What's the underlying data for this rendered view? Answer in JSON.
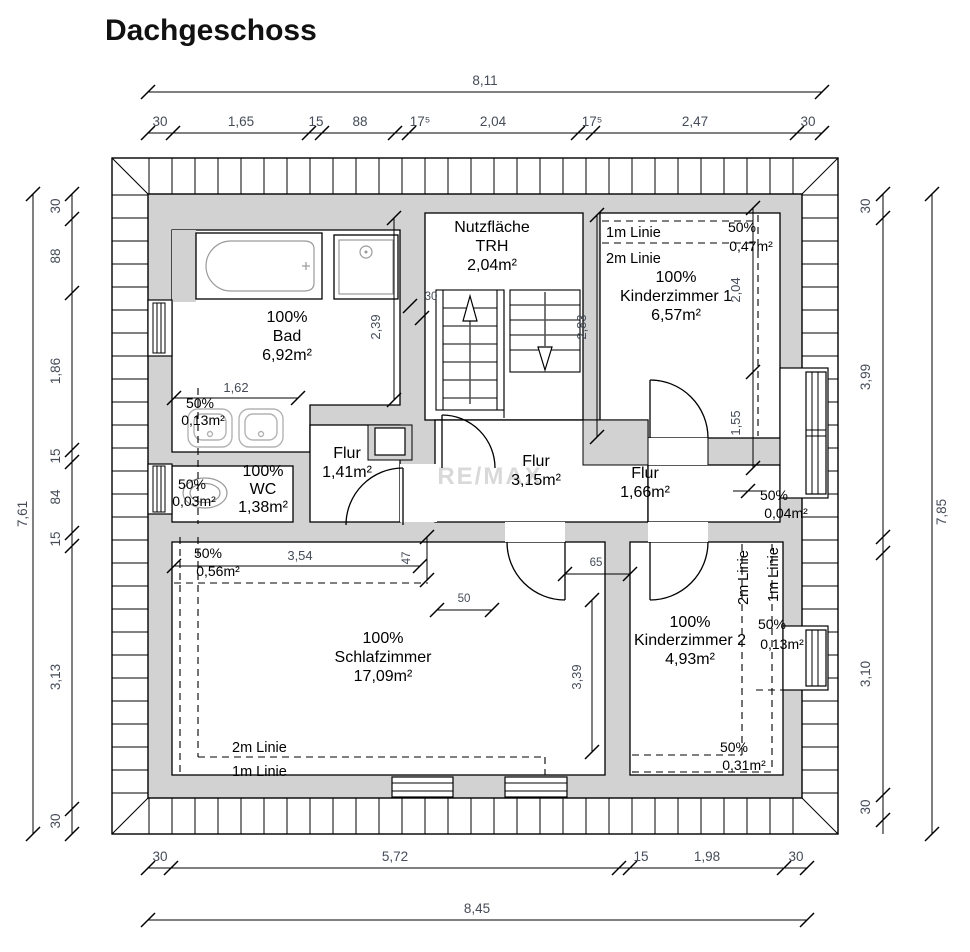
{
  "title": "Dachgeschoss",
  "watermark": "RE/MAX",
  "colors": {
    "wall_fill": "#d2d2d2",
    "dim_text": "#454c58",
    "watermark": "#d9d9d9"
  },
  "rooms": {
    "bad": {
      "lines": [
        "100%",
        "Bad",
        "6,92m²"
      ]
    },
    "trh": {
      "lines": [
        "Nutzfläche",
        "TRH",
        "2,04m²"
      ]
    },
    "kinderzimmer1": {
      "lines": [
        "100%",
        "Kinderzimmer 1",
        "6,57m²"
      ]
    },
    "wc": {
      "lines": [
        "100%",
        "WC",
        "1,38m²"
      ]
    },
    "flur_141": {
      "lines": [
        "Flur",
        "1,41m²"
      ]
    },
    "flur_315": {
      "lines": [
        "Flur",
        "3,15m²"
      ]
    },
    "flur_166": {
      "lines": [
        "Flur",
        "1,66m²"
      ]
    },
    "schlafzimmer": {
      "lines": [
        "100%",
        "Schlafzimmer",
        "17,09m²"
      ]
    },
    "kinderzimmer2": {
      "lines": [
        "100%",
        "Kinderzimmer 2",
        "4,93m²"
      ]
    }
  },
  "zones": {
    "bad": [
      "50%",
      "0,13m²"
    ],
    "wc": [
      "50%",
      "0,03m²"
    ],
    "schlafzimmer": [
      "50%",
      "0,56m²"
    ],
    "kinderzimmer1": [
      "50%",
      "0,47m²"
    ],
    "flur": [
      "50%",
      "0,04m²"
    ],
    "kinderzimmer2_mid": [
      "50%",
      "0,13m²"
    ],
    "kinderzimmer2_bottom": [
      "50%",
      "0,31m²"
    ]
  },
  "linie": {
    "one_m": "1m Linie",
    "two_m": "2m Linie"
  },
  "dims": {
    "top": {
      "total": "8,11",
      "segments": [
        "30",
        "1,65",
        "15",
        "88",
        "17⁵",
        "2,04",
        "17⁵",
        "2,47",
        "30"
      ]
    },
    "bottom": {
      "total": "8,45",
      "segments": [
        "30",
        "5,72",
        "15",
        "1,98",
        "30"
      ]
    },
    "left": {
      "total": "7,61",
      "segments": [
        "30",
        "88",
        "1,86",
        "15",
        "84",
        "15",
        "3,13",
        "30"
      ]
    },
    "right": {
      "total": "7,85",
      "segments": [
        "30",
        "3,99",
        "3,10",
        "30"
      ]
    },
    "inner": {
      "bad_width": "1,62",
      "bad_height": "2,39",
      "stair": "30",
      "kz1_left": "2,83",
      "kz1_right_upper": "2,04",
      "kz1_right_lower": "1,55",
      "schlaf_top": "3,54",
      "wall_a": "47",
      "wall_b": "50",
      "door_b": "65",
      "kz2_wall": "3,39"
    }
  }
}
